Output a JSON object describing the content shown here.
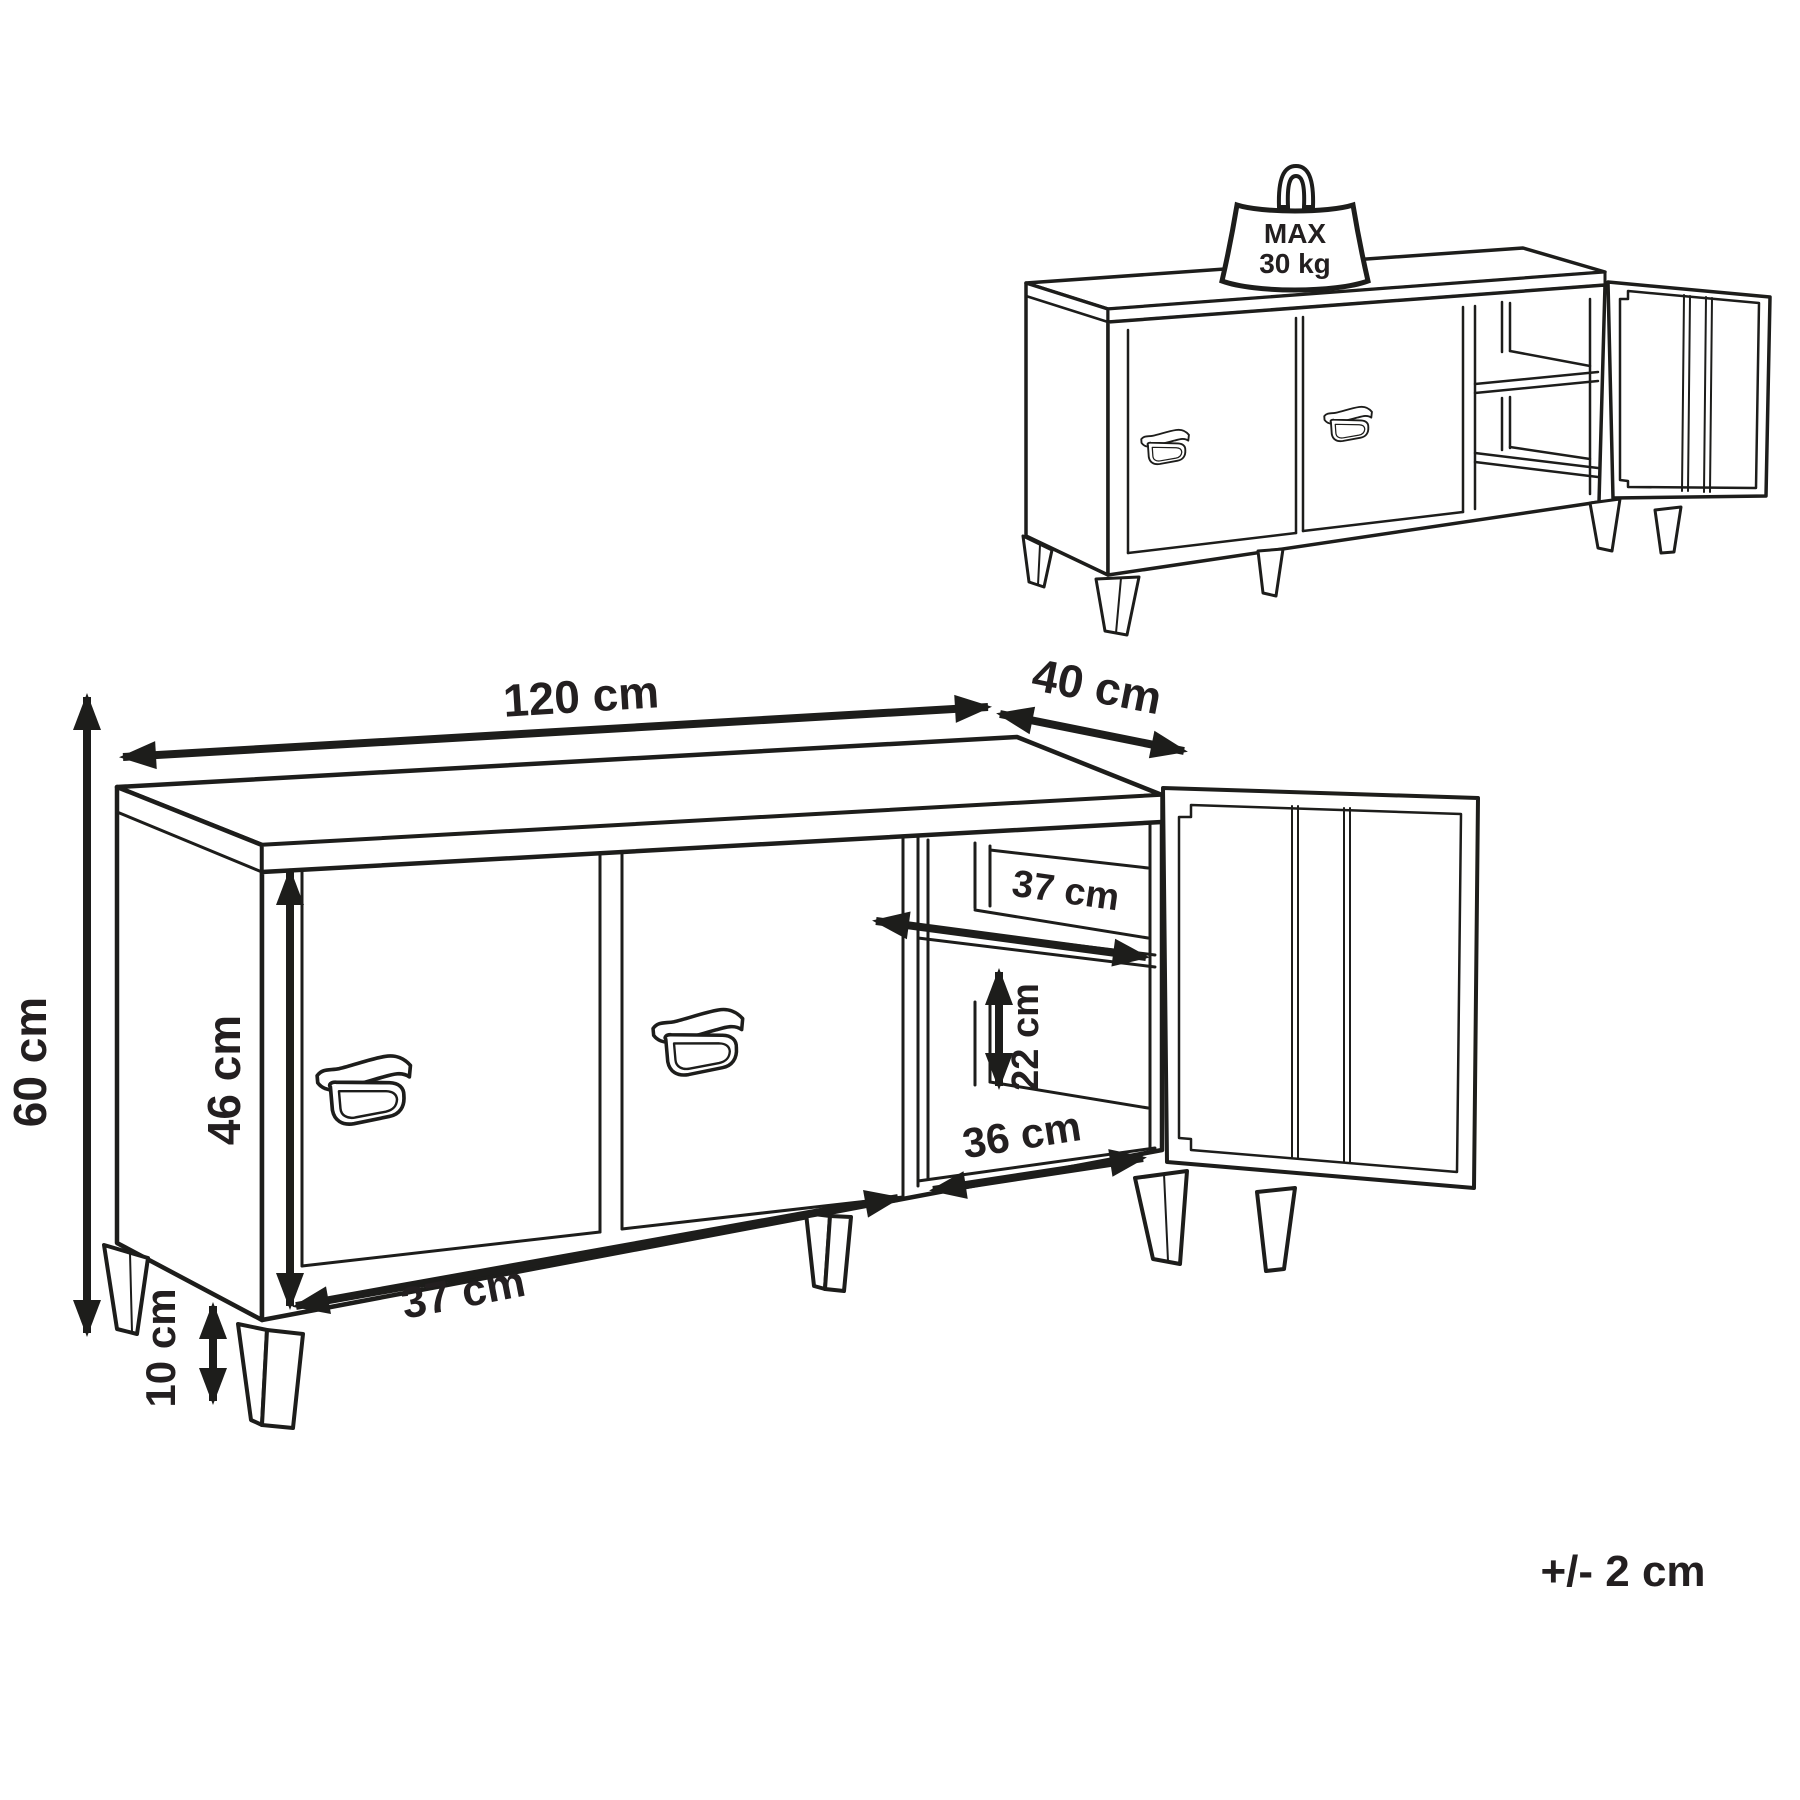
{
  "weight_badge": {
    "line1": "MAX",
    "line2": "30 kg"
  },
  "dimensions": {
    "width_top": "120 cm",
    "depth_top": "40 cm",
    "height_left": "60 cm",
    "door_height": "46 cm",
    "shelf_depth": "37 cm",
    "shelf_gap": "22 cm",
    "inner_width": "36 cm",
    "door_width": "37 cm",
    "leg_height": "10 cm"
  },
  "tolerance": "+/- 2 cm",
  "colors": {
    "line": "#1d1d1b",
    "text": "#231f20",
    "background": "#ffffff"
  }
}
